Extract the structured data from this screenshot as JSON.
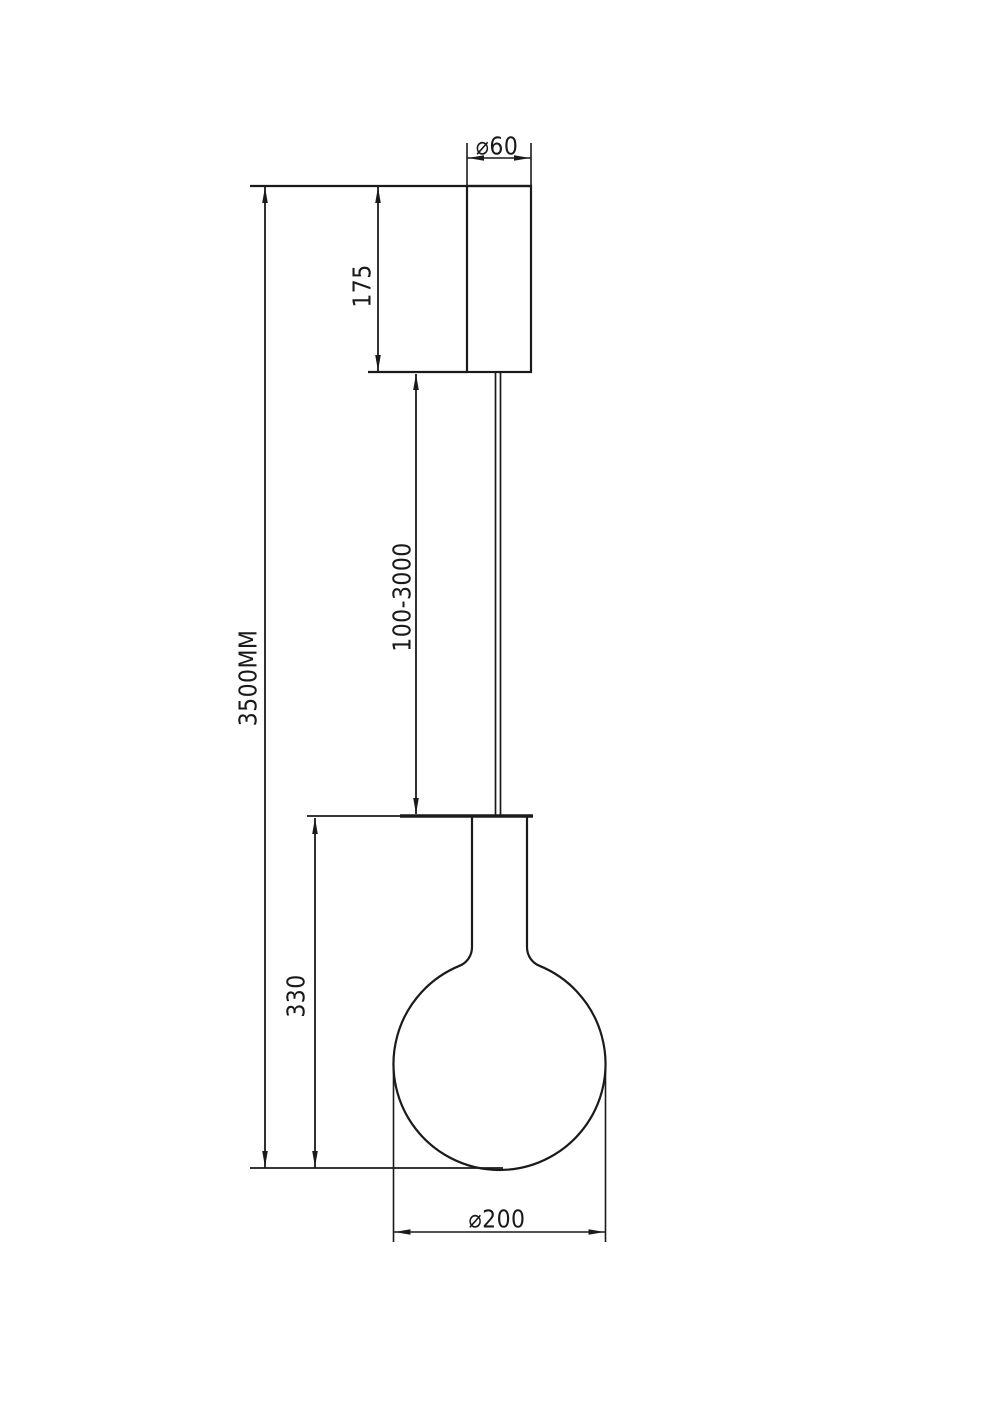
{
  "drawing": {
    "labels": {
      "canopy_diameter": "⌀60",
      "canopy_height": "175",
      "overall_height": "3500MM",
      "suspension_length": "100-3000",
      "fixture_height": "330",
      "shade_diameter": "⌀200"
    },
    "colors": {
      "line": "#1a1a1a",
      "background": "#ffffff"
    }
  }
}
